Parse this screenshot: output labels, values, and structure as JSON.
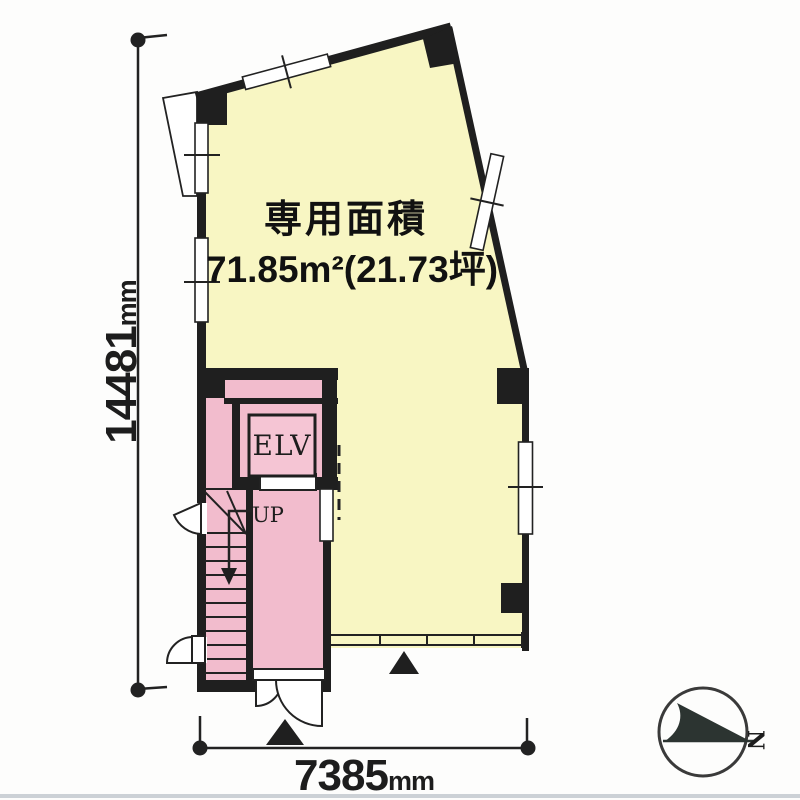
{
  "plan": {
    "area_label": "専用面積",
    "area_value": "71.85m²(21.73坪)",
    "elevator_label": "ELV",
    "stairs_direction_label": "UP",
    "compass_north_label": "N"
  },
  "dimensions": {
    "height": {
      "value": "14481",
      "unit": "mm"
    },
    "width": {
      "value": "7385",
      "unit": "mm"
    }
  },
  "colors": {
    "room-yellow": "#f8f6c3",
    "core-pink": "#f2bccd",
    "elv-pink": "#f5c5d4",
    "wall-black": "#1f1f1f",
    "line-dark": "#222222",
    "compass-needle": "#2c3431",
    "page-edge-gray": "#ccd1d6"
  }
}
